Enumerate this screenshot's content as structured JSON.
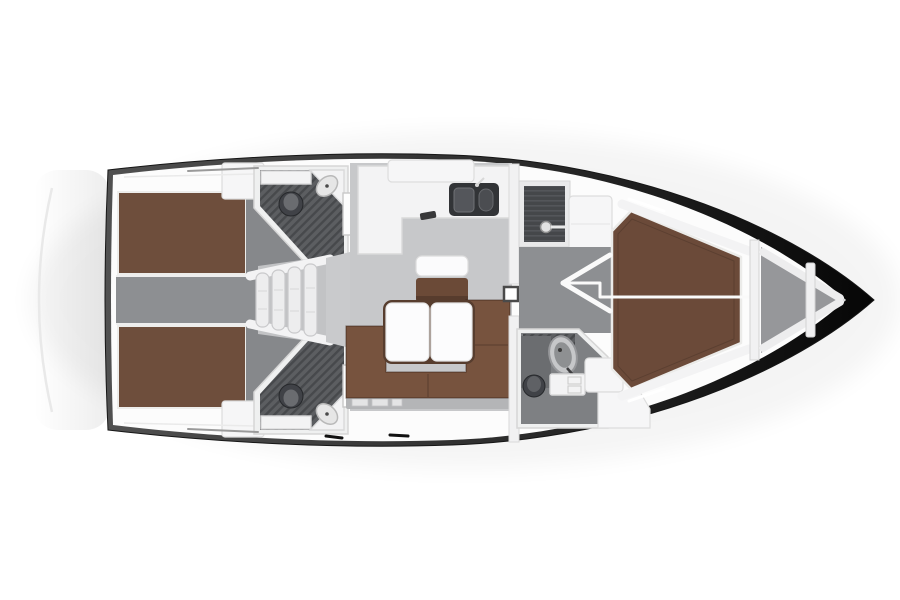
{
  "meta": {
    "title": "Sailing yacht interior layout — top-down floor plan, bow to the right",
    "view": "overhead plan",
    "bow_direction": "right",
    "stern_direction": "left"
  },
  "colors": {
    "hull_outline": "#161616",
    "hull_shade_start": "#515151",
    "hull_shade_mid": "#2e2e2e",
    "hull_shade_end": "#060606",
    "deck": "#fcfcfc",
    "furniture_white": "#f3f3f4",
    "locker_white": "#f6f6f7",
    "floor_salon": "#c7c8ca",
    "floor_corridor": "#8d8f92",
    "floor_cabin": "#86888b",
    "floor_head": "#7e8083",
    "wet_floor": "#5c5e61",
    "wet_stripe": "#47494c",
    "shower_floor": "#45474a",
    "shower_stripe": "#54565a",
    "berth_aft": "#6e4e3c",
    "berth_fwd": "#6b4a39",
    "sofa": "#77533e",
    "table_rim": "#573d2e",
    "desk": "#6b4a37",
    "fixture_dark": "#404247",
    "plinth": "#b4b5b7",
    "anchor_floor": "#96979a",
    "line_white": "#fafafa",
    "stairs": "#ededee",
    "swim_arc": "#e9e9e9"
  },
  "legend": {
    "areas": [
      {
        "id": "swim-platform",
        "label": "Stern swim platform outline"
      },
      {
        "id": "aft-cabin-port",
        "label": "Aft double cabin (port)"
      },
      {
        "id": "aft-cabin-starboard",
        "label": "Aft double cabin (starboard)"
      },
      {
        "id": "aft-corridor",
        "label": "Aft corridor between cabins"
      },
      {
        "id": "aft-head-port",
        "label": "Aft head with shower (port)"
      },
      {
        "id": "aft-head-starboard",
        "label": "Aft head with shower (starboard)"
      },
      {
        "id": "companionway",
        "label": "Companionway steps"
      },
      {
        "id": "galley",
        "label": "L-shaped galley with twin sinks"
      },
      {
        "id": "chart-table",
        "label": "Chart table with seat"
      },
      {
        "id": "salon",
        "label": "Salon with U-shaped sofa and folding table"
      },
      {
        "id": "shower-room",
        "label": "Separate shower compartment"
      },
      {
        "id": "forward-corridor",
        "label": "Forward passage with door-swing arrow"
      },
      {
        "id": "forward-head",
        "label": "Forward head"
      },
      {
        "id": "forward-cabin",
        "label": "Forward V-berth cabin"
      },
      {
        "id": "anchor-locker",
        "label": "Anchor locker in bow"
      }
    ]
  }
}
